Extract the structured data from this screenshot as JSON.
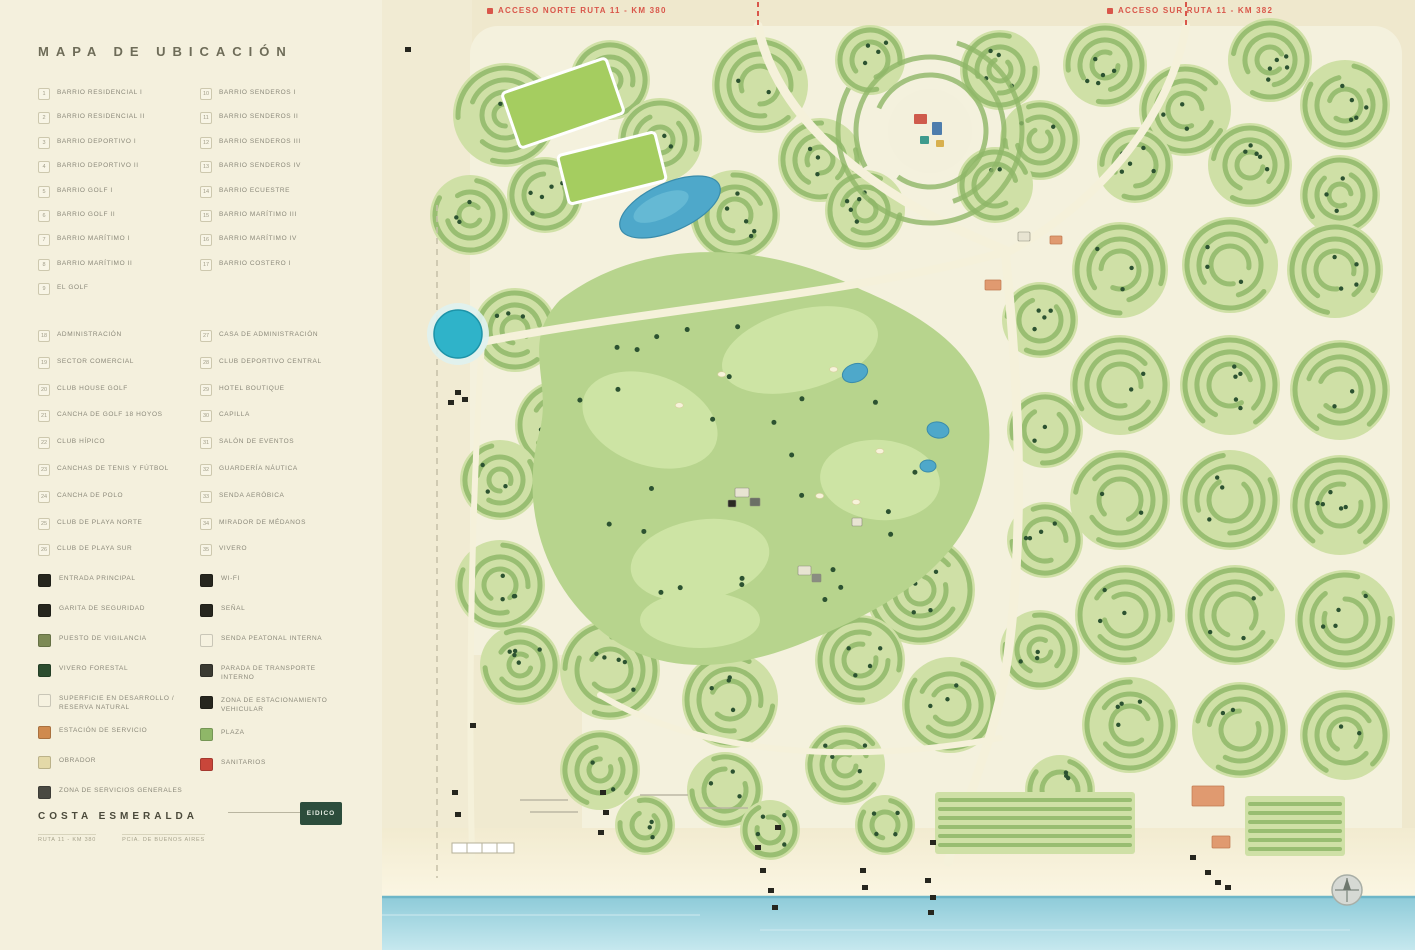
{
  "title": "MAPA DE UBICACIÓN",
  "access_labels": {
    "north": "ACCESO NORTE RUTA 11 - KM 380",
    "south": "ACCESO SUR RUTA 11 - KM 382"
  },
  "legend": {
    "barrios": {
      "left": [
        {
          "num": "1",
          "label": "Barrio Residencial I"
        },
        {
          "num": "2",
          "label": "Barrio Residencial II"
        },
        {
          "num": "3",
          "label": "Barrio Deportivo I"
        },
        {
          "num": "4",
          "label": "Barrio Deportivo II"
        },
        {
          "num": "5",
          "label": "Barrio Golf I"
        },
        {
          "num": "6",
          "label": "Barrio Golf II"
        },
        {
          "num": "7",
          "label": "Barrio Marítimo I"
        },
        {
          "num": "8",
          "label": "Barrio Marítimo II"
        },
        {
          "num": "9",
          "label": "El Golf"
        }
      ],
      "right": [
        {
          "num": "10",
          "label": "Barrio Senderos I"
        },
        {
          "num": "11",
          "label": "Barrio Senderos II"
        },
        {
          "num": "12",
          "label": "Barrio Senderos III"
        },
        {
          "num": "13",
          "label": "Barrio Senderos IV"
        },
        {
          "num": "14",
          "label": "Barrio Ecuestre"
        },
        {
          "num": "15",
          "label": "Barrio Marítimo III"
        },
        {
          "num": "16",
          "label": "Barrio Marítimo IV"
        },
        {
          "num": "17",
          "label": "Barrio Costero I"
        }
      ]
    },
    "amenities": {
      "left": [
        {
          "num": "18",
          "label": "Administración"
        },
        {
          "num": "19",
          "label": "Sector Comercial"
        },
        {
          "num": "20",
          "label": "Club House Golf"
        },
        {
          "num": "21",
          "label": "Cancha de Golf 18 Hoyos"
        },
        {
          "num": "22",
          "label": "Club Hípico"
        },
        {
          "num": "23",
          "label": "Canchas de Tenis y Fútbol"
        },
        {
          "num": "24",
          "label": "Cancha de Polo"
        },
        {
          "num": "25",
          "label": "Club de Playa Norte"
        },
        {
          "num": "26",
          "label": "Club de Playa Sur"
        }
      ],
      "right": [
        {
          "num": "27",
          "label": "Casa de Administración"
        },
        {
          "num": "28",
          "label": "Club Deportivo Central"
        },
        {
          "num": "29",
          "label": "Hotel Boutique"
        },
        {
          "num": "30",
          "label": "Capilla"
        },
        {
          "num": "31",
          "label": "Salón de Eventos"
        },
        {
          "num": "32",
          "label": "Guardería Náutica"
        },
        {
          "num": "33",
          "label": "Senda Aeróbica"
        },
        {
          "num": "34",
          "label": "Mirador de Médanos"
        },
        {
          "num": "35",
          "label": "Vivero"
        }
      ]
    },
    "symbols": {
      "left": [
        {
          "icon": "entrance-icon",
          "color": "#26261e",
          "label": "Entrada Principal"
        },
        {
          "icon": "security-icon",
          "color": "#26261e",
          "label": "Garita de Seguridad"
        },
        {
          "icon": "watch-post-icon",
          "color": "#7d8a55",
          "label": "Puesto de Vigilancia"
        },
        {
          "icon": "forest-icon",
          "color": "#2c4d2f",
          "label": "Vivero Forestal"
        },
        {
          "icon": "future-area-icon",
          "color": "#f6f2e0",
          "label": "Superficie en Desarrollo / Reserva Natural"
        },
        {
          "icon": "service-station-icon",
          "color": "#cf8a4e",
          "label": "Estación de Servicio"
        },
        {
          "icon": "works-icon",
          "color": "#e4d9a8",
          "label": "Obrador"
        },
        {
          "icon": "services-area-icon",
          "color": "#4a4a42",
          "label": "Zona de Servicios Generales"
        }
      ],
      "right": [
        {
          "icon": "wifi-icon",
          "color": "#26261e",
          "label": "Wi-Fi"
        },
        {
          "icon": "signal-icon",
          "color": "#26261e",
          "label": "Señal"
        },
        {
          "icon": "trail-icon",
          "color": "#f6f2e0",
          "label": "Senda Peatonal Interna"
        },
        {
          "icon": "bus-stop-icon",
          "color": "#3a3a32",
          "label": "Parada de Transporte Interno"
        },
        {
          "icon": "parking-icon",
          "color": "#26261e",
          "label": "Zona de Estacionamiento Vehicular"
        },
        {
          "icon": "plaza-icon",
          "color": "#8fb768",
          "label": "Plaza"
        },
        {
          "icon": "restrooms-icon",
          "color": "#c9463a",
          "label": "Sanitarios"
        }
      ]
    }
  },
  "footer": {
    "brand": "COSTA ESMERALDA",
    "logo_text": "EIDICO",
    "lines": [
      "Ruta 11 - Km 380",
      "Pcia. de Buenos Aires"
    ]
  },
  "map": {
    "colors": {
      "paper": "#f3efdc",
      "sand": "#efe8cd",
      "dev_bg": "#f4f1dd",
      "nb_light": "#cfe0a6",
      "nb_ring": "#8fb768",
      "tree": "#2c5231",
      "golf": "#b7d48d",
      "fairway": "#cde4a4",
      "water": "#4ea8ca",
      "teal_pond": "#2fb3c9",
      "ocean_near": "#8ecbd9",
      "ocean_far": "#c6e8ee",
      "road": "#f5f1da",
      "accent_red": "#d9564a",
      "building": "#26261e",
      "orange_building": "#e09a70",
      "field_green": "#a5cd60"
    },
    "neighborhoods": [
      [
        505,
        115,
        52
      ],
      [
        470,
        215,
        40
      ],
      [
        545,
        195,
        38
      ],
      [
        610,
        80,
        40
      ],
      [
        660,
        140,
        42
      ],
      [
        760,
        85,
        48
      ],
      [
        820,
        160,
        42
      ],
      [
        735,
        215,
        45
      ],
      [
        870,
        60,
        35
      ],
      [
        1000,
        70,
        40
      ],
      [
        1040,
        140,
        40
      ],
      [
        865,
        210,
        40
      ],
      [
        995,
        185,
        38
      ],
      [
        1105,
        65,
        42
      ],
      [
        1185,
        110,
        46
      ],
      [
        1270,
        60,
        42
      ],
      [
        1345,
        105,
        45
      ],
      [
        1135,
        165,
        38
      ],
      [
        1250,
        165,
        42
      ],
      [
        1340,
        195,
        40
      ],
      [
        1120,
        270,
        48
      ],
      [
        1230,
        265,
        48
      ],
      [
        1335,
        270,
        48
      ],
      [
        1120,
        385,
        50
      ],
      [
        1230,
        385,
        50
      ],
      [
        1340,
        390,
        50
      ],
      [
        1120,
        500,
        50
      ],
      [
        1230,
        500,
        50
      ],
      [
        1340,
        505,
        50
      ],
      [
        1125,
        615,
        50
      ],
      [
        1235,
        615,
        50
      ],
      [
        1345,
        620,
        50
      ],
      [
        1130,
        725,
        48
      ],
      [
        1240,
        730,
        48
      ],
      [
        1345,
        735,
        45
      ],
      [
        1040,
        320,
        38
      ],
      [
        1045,
        430,
        38
      ],
      [
        1045,
        540,
        38
      ],
      [
        1040,
        650,
        40
      ],
      [
        920,
        590,
        55
      ],
      [
        950,
        705,
        48
      ],
      [
        860,
        660,
        45
      ],
      [
        845,
        765,
        40
      ],
      [
        730,
        700,
        48
      ],
      [
        725,
        790,
        38
      ],
      [
        610,
        670,
        50
      ],
      [
        600,
        770,
        40
      ],
      [
        500,
        585,
        45
      ],
      [
        520,
        665,
        40
      ],
      [
        515,
        330,
        42
      ],
      [
        560,
        425,
        45
      ],
      [
        500,
        480,
        40
      ],
      [
        645,
        825,
        30
      ],
      [
        770,
        830,
        30
      ],
      [
        885,
        825,
        30
      ],
      [
        1060,
        790,
        35
      ]
    ],
    "golf_path": "M560,300 C640,238 760,238 862,290 C962,332 1002,382 986,470 C970,560 900,602 810,640 C740,670 660,680 600,630 C540,580 520,500 540,430 C552,380 520,342 560,300 Z",
    "fairways": [
      [
        650,
        420,
        70,
        45,
        20
      ],
      [
        800,
        350,
        80,
        40,
        -15
      ],
      [
        880,
        480,
        60,
        40,
        5
      ],
      [
        700,
        560,
        70,
        40,
        -10
      ],
      [
        700,
        620,
        60,
        28,
        0
      ]
    ],
    "golf_ponds": [
      [
        855,
        373,
        13,
        9,
        -20
      ],
      [
        938,
        430,
        11,
        8,
        10
      ],
      [
        928,
        466,
        8,
        6,
        0
      ]
    ],
    "kidney_lake": {
      "cx": 670,
      "cy": 207,
      "rx": 54,
      "ry": 24,
      "rot": -24
    },
    "teal_pond": {
      "cx": 458,
      "cy": 334,
      "r": 24
    },
    "polo_fields": [
      [
        563,
        103,
        110,
        58,
        -19
      ],
      [
        612,
        168,
        100,
        50,
        -14
      ]
    ],
    "plaza": {
      "cx": 930,
      "cy": 131
    },
    "plaza_buildings": [
      [
        914,
        114,
        13,
        10,
        "#cf5b4c"
      ],
      [
        932,
        122,
        10,
        13,
        "#4d7dad"
      ],
      [
        920,
        136,
        9,
        8,
        "#3d9b8d"
      ],
      [
        936,
        140,
        8,
        7,
        "#d8b04e"
      ]
    ],
    "maritimo_blocks": [
      [
        935,
        792,
        200,
        62
      ],
      [
        1245,
        796,
        100,
        60
      ]
    ],
    "orange_structures": [
      [
        985,
        280,
        16,
        10
      ],
      [
        1050,
        236,
        12,
        8
      ],
      [
        1192,
        786,
        32,
        20
      ],
      [
        1212,
        836,
        18,
        12
      ]
    ],
    "roads": [
      [
        "M758,26 C775,110 855,190 1005,250",
        9
      ],
      [
        "M1005,250 C1018,380 1026,520 1008,655 C998,730 968,795 948,862",
        9
      ],
      [
        "M1186,26 C1172,110 1105,200 1008,252",
        8
      ],
      [
        "M1005,252 C850,295 645,310 482,342",
        8
      ],
      [
        "M482,342 C472,500 468,680 472,858",
        6
      ],
      [
        "M600,695 C700,755 850,765 1000,738",
        6
      ]
    ],
    "access_dashes": [
      "M758,2 L758,26",
      "M1186,2 L1186,26"
    ],
    "side_road": "M437,205 L437,878",
    "buildings": [
      [
        405,
        47
      ],
      [
        455,
        390
      ],
      [
        462,
        397
      ],
      [
        448,
        400
      ],
      [
        470,
        723
      ],
      [
        452,
        790
      ],
      [
        455,
        812
      ],
      [
        600,
        790
      ],
      [
        603,
        810
      ],
      [
        598,
        830
      ],
      [
        755,
        845
      ],
      [
        760,
        868
      ],
      [
        768,
        888
      ],
      [
        772,
        905
      ],
      [
        860,
        868
      ],
      [
        862,
        885
      ],
      [
        925,
        878
      ],
      [
        930,
        895
      ],
      [
        928,
        910
      ],
      [
        1190,
        855
      ],
      [
        1205,
        870
      ],
      [
        1215,
        880
      ],
      [
        1225,
        885
      ],
      [
        930,
        840
      ],
      [
        775,
        825
      ]
    ],
    "clubhouse_clusters": [
      [
        735,
        488,
        14,
        9,
        "#e8e4d2"
      ],
      [
        750,
        498,
        10,
        8,
        "#6b6f66"
      ],
      [
        728,
        500,
        8,
        7,
        "#2a2a22"
      ],
      [
        798,
        566,
        13,
        9,
        "#e8e4d2"
      ],
      [
        812,
        574,
        9,
        8,
        "#8a8d82"
      ],
      [
        852,
        518,
        10,
        8,
        "#e8e4d2"
      ],
      [
        1018,
        232,
        12,
        9,
        "#e8e4d2"
      ]
    ],
    "compass": {
      "cx": 1347,
      "cy": 890,
      "r": 15
    }
  }
}
